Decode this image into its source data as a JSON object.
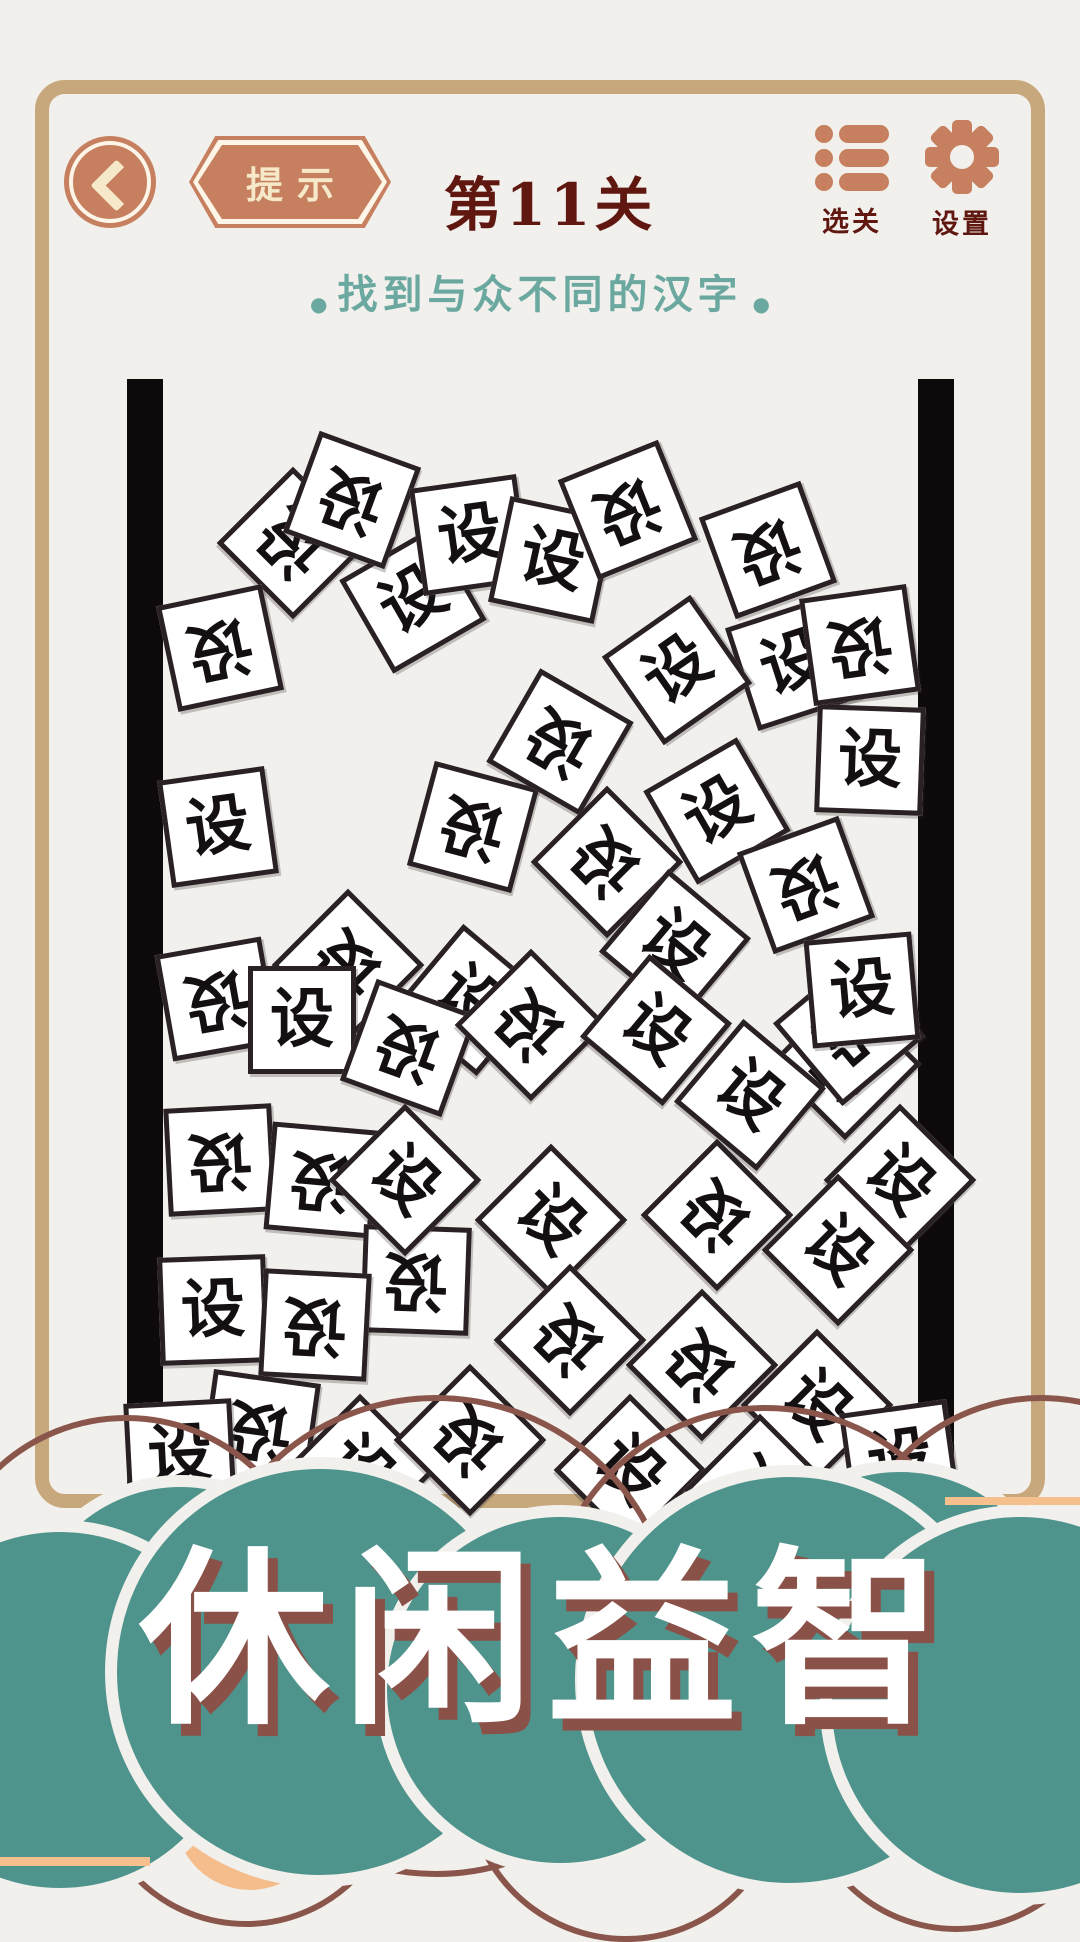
{
  "header": {
    "hint_label": "提示",
    "level_title": "第11关",
    "nav": [
      {
        "label": "选关"
      },
      {
        "label": "设置"
      }
    ]
  },
  "subtitle": {
    "bullet": "●",
    "text": "找到与众不同的汉字"
  },
  "game": {
    "tile_char": "设",
    "tiles": [
      {
        "x": 293,
        "y": 543,
        "r": 45,
        "cr": 180
      },
      {
        "x": 220,
        "y": 648,
        "r": -12,
        "cr": 180
      },
      {
        "x": 413,
        "y": 600,
        "r": -30,
        "cr": 0
      },
      {
        "x": 352,
        "y": 500,
        "r": 20,
        "cr": 180
      },
      {
        "x": 470,
        "y": 535,
        "r": -8,
        "cr": 0
      },
      {
        "x": 552,
        "y": 560,
        "r": 12,
        "cr": 0
      },
      {
        "x": 628,
        "y": 510,
        "r": -22,
        "cr": 180
      },
      {
        "x": 768,
        "y": 550,
        "r": -20,
        "cr": 180
      },
      {
        "x": 793,
        "y": 663,
        "r": -18,
        "cr": 0
      },
      {
        "x": 677,
        "y": 670,
        "r": -35,
        "cr": 0
      },
      {
        "x": 870,
        "y": 760,
        "r": 2,
        "cr": 0
      },
      {
        "x": 860,
        "y": 645,
        "r": -8,
        "cr": 180
      },
      {
        "x": 218,
        "y": 827,
        "r": -8,
        "cr": 0
      },
      {
        "x": 217,
        "y": 999,
        "r": -10,
        "cr": 180
      },
      {
        "x": 348,
        "y": 965,
        "r": 45,
        "cr": 180
      },
      {
        "x": 470,
        "y": 1000,
        "r": 40,
        "cr": 0
      },
      {
        "x": 473,
        "y": 827,
        "r": 15,
        "cr": 180
      },
      {
        "x": 560,
        "y": 742,
        "r": 30,
        "cr": 180
      },
      {
        "x": 607,
        "y": 862,
        "r": 45,
        "cr": 180
      },
      {
        "x": 675,
        "y": 945,
        "r": 40,
        "cr": 0
      },
      {
        "x": 717,
        "y": 811,
        "r": -30,
        "cr": 0
      },
      {
        "x": 806,
        "y": 885,
        "r": -20,
        "cr": 180
      },
      {
        "x": 845,
        "y": 1064,
        "r": 45,
        "cr": 180
      },
      {
        "x": 900,
        "y": 1180,
        "r": 45,
        "cr": 0
      },
      {
        "x": 220,
        "y": 1160,
        "r": -3,
        "cr": 180
      },
      {
        "x": 322,
        "y": 1180,
        "r": 5,
        "cr": 180
      },
      {
        "x": 416,
        "y": 1280,
        "r": 2,
        "cr": 180
      },
      {
        "x": 302,
        "y": 1020,
        "r": 0,
        "cr": 0
      },
      {
        "x": 409,
        "y": 1048,
        "r": 20,
        "cr": 180
      },
      {
        "x": 531,
        "y": 1025,
        "r": 45,
        "cr": 180
      },
      {
        "x": 656,
        "y": 1030,
        "r": 40,
        "cr": 0
      },
      {
        "x": 750,
        "y": 1095,
        "r": 40,
        "cr": 0
      },
      {
        "x": 849,
        "y": 1030,
        "r": -40,
        "cr": 180
      },
      {
        "x": 551,
        "y": 1220,
        "r": 45,
        "cr": 0
      },
      {
        "x": 717,
        "y": 1215,
        "r": 45,
        "cr": 180
      },
      {
        "x": 838,
        "y": 1250,
        "r": 45,
        "cr": 0
      },
      {
        "x": 570,
        "y": 1340,
        "r": 45,
        "cr": 180
      },
      {
        "x": 702,
        "y": 1365,
        "r": 45,
        "cr": 180
      },
      {
        "x": 817,
        "y": 1405,
        "r": 45,
        "cr": 0
      },
      {
        "x": 213,
        "y": 1310,
        "r": -2,
        "cr": 0
      },
      {
        "x": 315,
        "y": 1325,
        "r": 3,
        "cr": 180
      },
      {
        "x": 862,
        "y": 990,
        "r": -5,
        "cr": 0
      },
      {
        "x": 260,
        "y": 1430,
        "r": 8,
        "cr": 180
      },
      {
        "x": 180,
        "y": 1455,
        "r": -3,
        "cr": 0
      },
      {
        "x": 360,
        "y": 1470,
        "r": 45,
        "cr": 0
      },
      {
        "x": 470,
        "y": 1440,
        "r": 45,
        "cr": 180
      },
      {
        "x": 630,
        "y": 1470,
        "r": 45,
        "cr": 0
      },
      {
        "x": 760,
        "y": 1490,
        "r": 45,
        "cr": 180
      },
      {
        "x": 900,
        "y": 1460,
        "r": -8,
        "cr": 0
      },
      {
        "x": 405,
        "y": 1180,
        "r": 45,
        "cr": 0
      }
    ]
  },
  "banner": {
    "title": "休闲益智"
  },
  "colors": {
    "background": "#f2f0ec",
    "frame": "#c7a87d",
    "accent_salmon": "#c6805f",
    "title_maroon": "#5f1710",
    "subtitle_teal": "#6aa8a0",
    "wall_black": "#0e0a0b",
    "banner_teal": "#4f948c",
    "arc_maroon": "#8a564c",
    "accent_peach": "#f6bf8e",
    "banner_shadow": "#8a5148"
  }
}
